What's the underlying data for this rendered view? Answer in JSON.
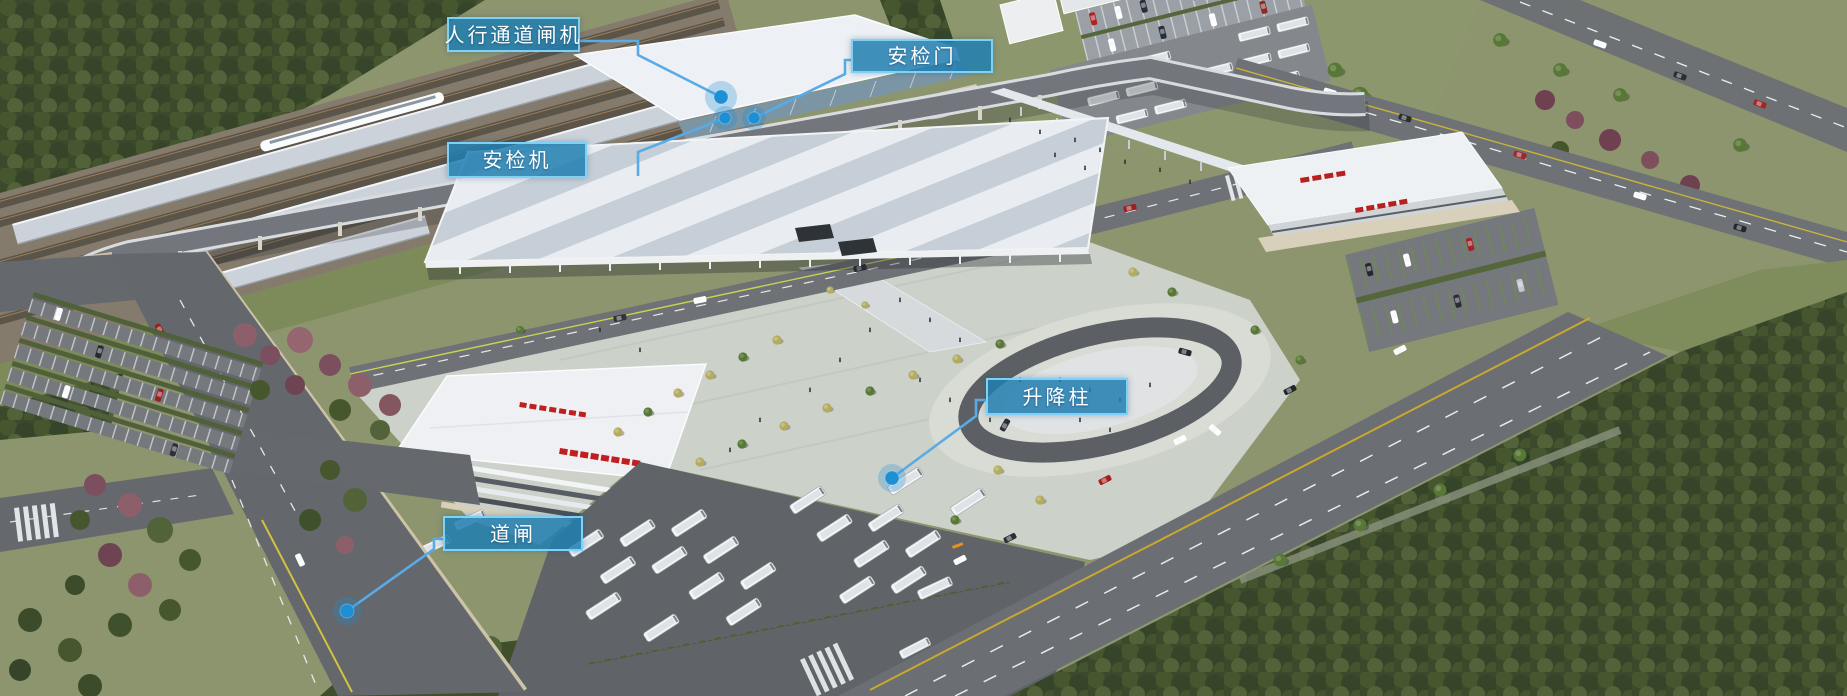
{
  "scene": {
    "description": "Aerial rendering of a railway station transport hub with annotated access-control equipment"
  },
  "annotations": {
    "labels": [
      {
        "id": "pedestrian-channel-gate",
        "text": "人行通道闸机"
      },
      {
        "id": "security-door",
        "text": "安检门"
      },
      {
        "id": "security-scanner",
        "text": "安检机"
      },
      {
        "id": "lifting-bollard",
        "text": "升降柱"
      },
      {
        "id": "road-barrier-gate",
        "text": "道闸"
      }
    ]
  },
  "colors": {
    "label_background": "rgba(32,126,176,0.85)",
    "label_border": "#7ed0f4",
    "leader_line": "#58abe6",
    "marker_dot": "#1d8fd4"
  }
}
